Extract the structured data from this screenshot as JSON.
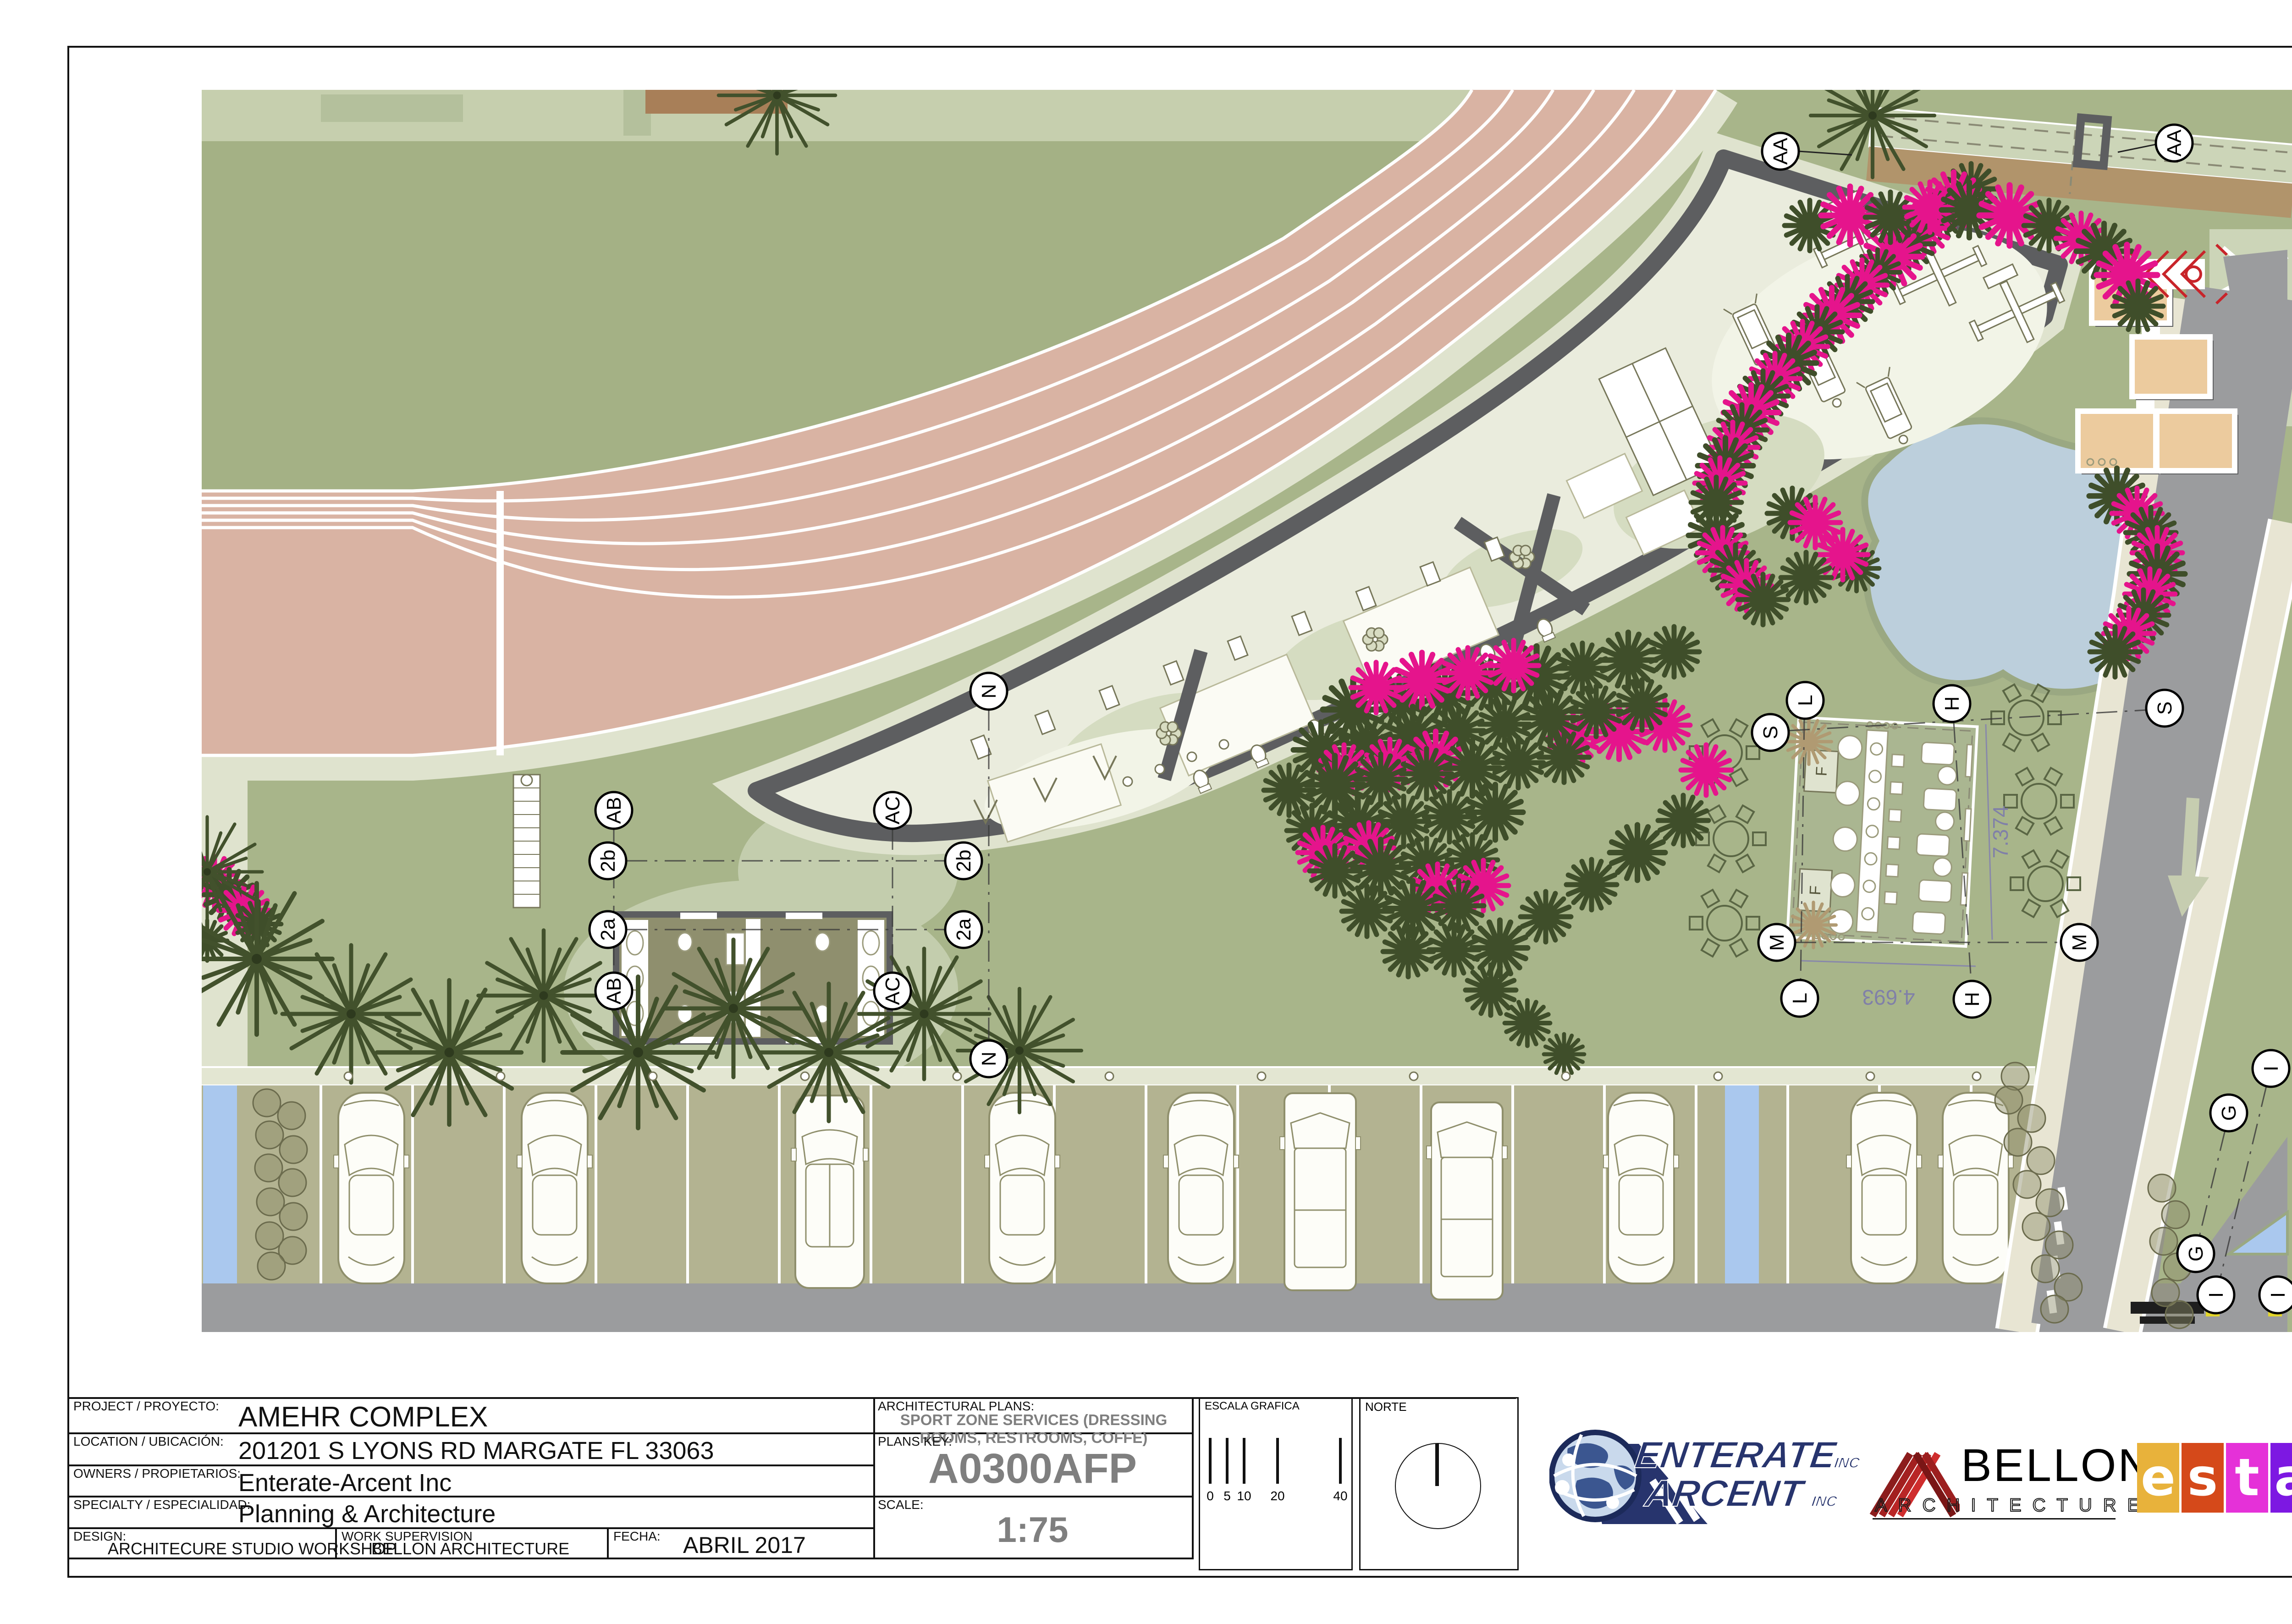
{
  "sheet": {
    "project_label": "PROJECT / PROYECTO:",
    "project_value": "AMEHR COMPLEX",
    "location_label": "LOCATION / UBICACIÓN:",
    "location_value": "201201 S LYONS RD MARGATE FL 33063",
    "owners_label": "OWNERS / PROPIETARIOS:",
    "owners_value": "Enterate-Arcent Inc",
    "specialty_label": "SPECIALTY / ESPECIALIDAD:",
    "specialty_value": "Planning & Architecture",
    "design_label": "DESIGN:",
    "design_value": "ARCHITECURE STUDIO WORKSHOP",
    "supervision_label": "WORK SUPERVISION",
    "supervision_value": "BELLON ARCHITECTURE",
    "date_label": "FECHA:",
    "date_value": "ABRIL 2017",
    "plans_label": "ARCHITECTURAL PLANS:",
    "plans_value": "SPORT ZONE SERVICES (DRESSING ROOMS, RESTROOMS, COFFE)",
    "key_label": "PLANS KEY:",
    "key_value": "A0300AFP",
    "scale_label": "SCALE:",
    "scale_value": "1:75",
    "graphic_scale_label": "ESCALA GRAFICA",
    "graphic_scale_ticks": [
      "0",
      "5",
      "10",
      "20",
      "40"
    ],
    "north_label": "NORTE"
  },
  "plan": {
    "bubbles": [
      {
        "label": "AA"
      },
      {
        "label": "AA"
      },
      {
        "label": "AB"
      },
      {
        "label": "AB"
      },
      {
        "label": "AC"
      },
      {
        "label": "AC"
      },
      {
        "label": "2b"
      },
      {
        "label": "2b"
      },
      {
        "label": "2a"
      },
      {
        "label": "2a"
      },
      {
        "label": "N"
      },
      {
        "label": "N"
      },
      {
        "label": "S"
      },
      {
        "label": "S"
      },
      {
        "label": "L"
      },
      {
        "label": "L"
      },
      {
        "label": "H"
      },
      {
        "label": "H"
      },
      {
        "label": "M"
      },
      {
        "label": "M"
      },
      {
        "label": "G"
      },
      {
        "label": "G"
      },
      {
        "label": "I"
      },
      {
        "label": "I"
      },
      {
        "label": "I"
      }
    ],
    "dim_width": "7.374",
    "dim_length": "4.693",
    "cafe_f1": "F",
    "cafe_f2": "F"
  },
  "logos": {
    "enterate": {
      "line1": "ENTERATE",
      "line1_suffix": "INC",
      "line2": "ARCENT",
      "line2_suffix": "INC"
    },
    "bellon": {
      "name": "BELLON",
      "subtitle": "ARCHITECTURE"
    },
    "estar": {
      "letters": [
        "e",
        "s",
        "t",
        "a",
        "r"
      ]
    }
  },
  "colors": {
    "lawn": "#a8b58a",
    "infield": "#a4b185",
    "track": "#d9b3a3",
    "walk": "#dfe3ce",
    "building_wall": "#5d5e60",
    "building_floor": "#eaecdd",
    "pond": "#bccfdc",
    "parking_stall": "#b3b391",
    "asphalt": "#9b9c9e",
    "road_median": "#e8e5d3",
    "magenta_bush": "#e5148c",
    "dark_tree": "#3f4e2a",
    "tan_pad": "#eccb9e",
    "accessible_blue": "#aac8ee",
    "navy_logo": "#27346d",
    "bellon_red": "#b22222",
    "estar_tiles": [
      "#e8b23b",
      "#d5491a",
      "#e531d8",
      "#7d18e2",
      "#1f17ee"
    ]
  }
}
